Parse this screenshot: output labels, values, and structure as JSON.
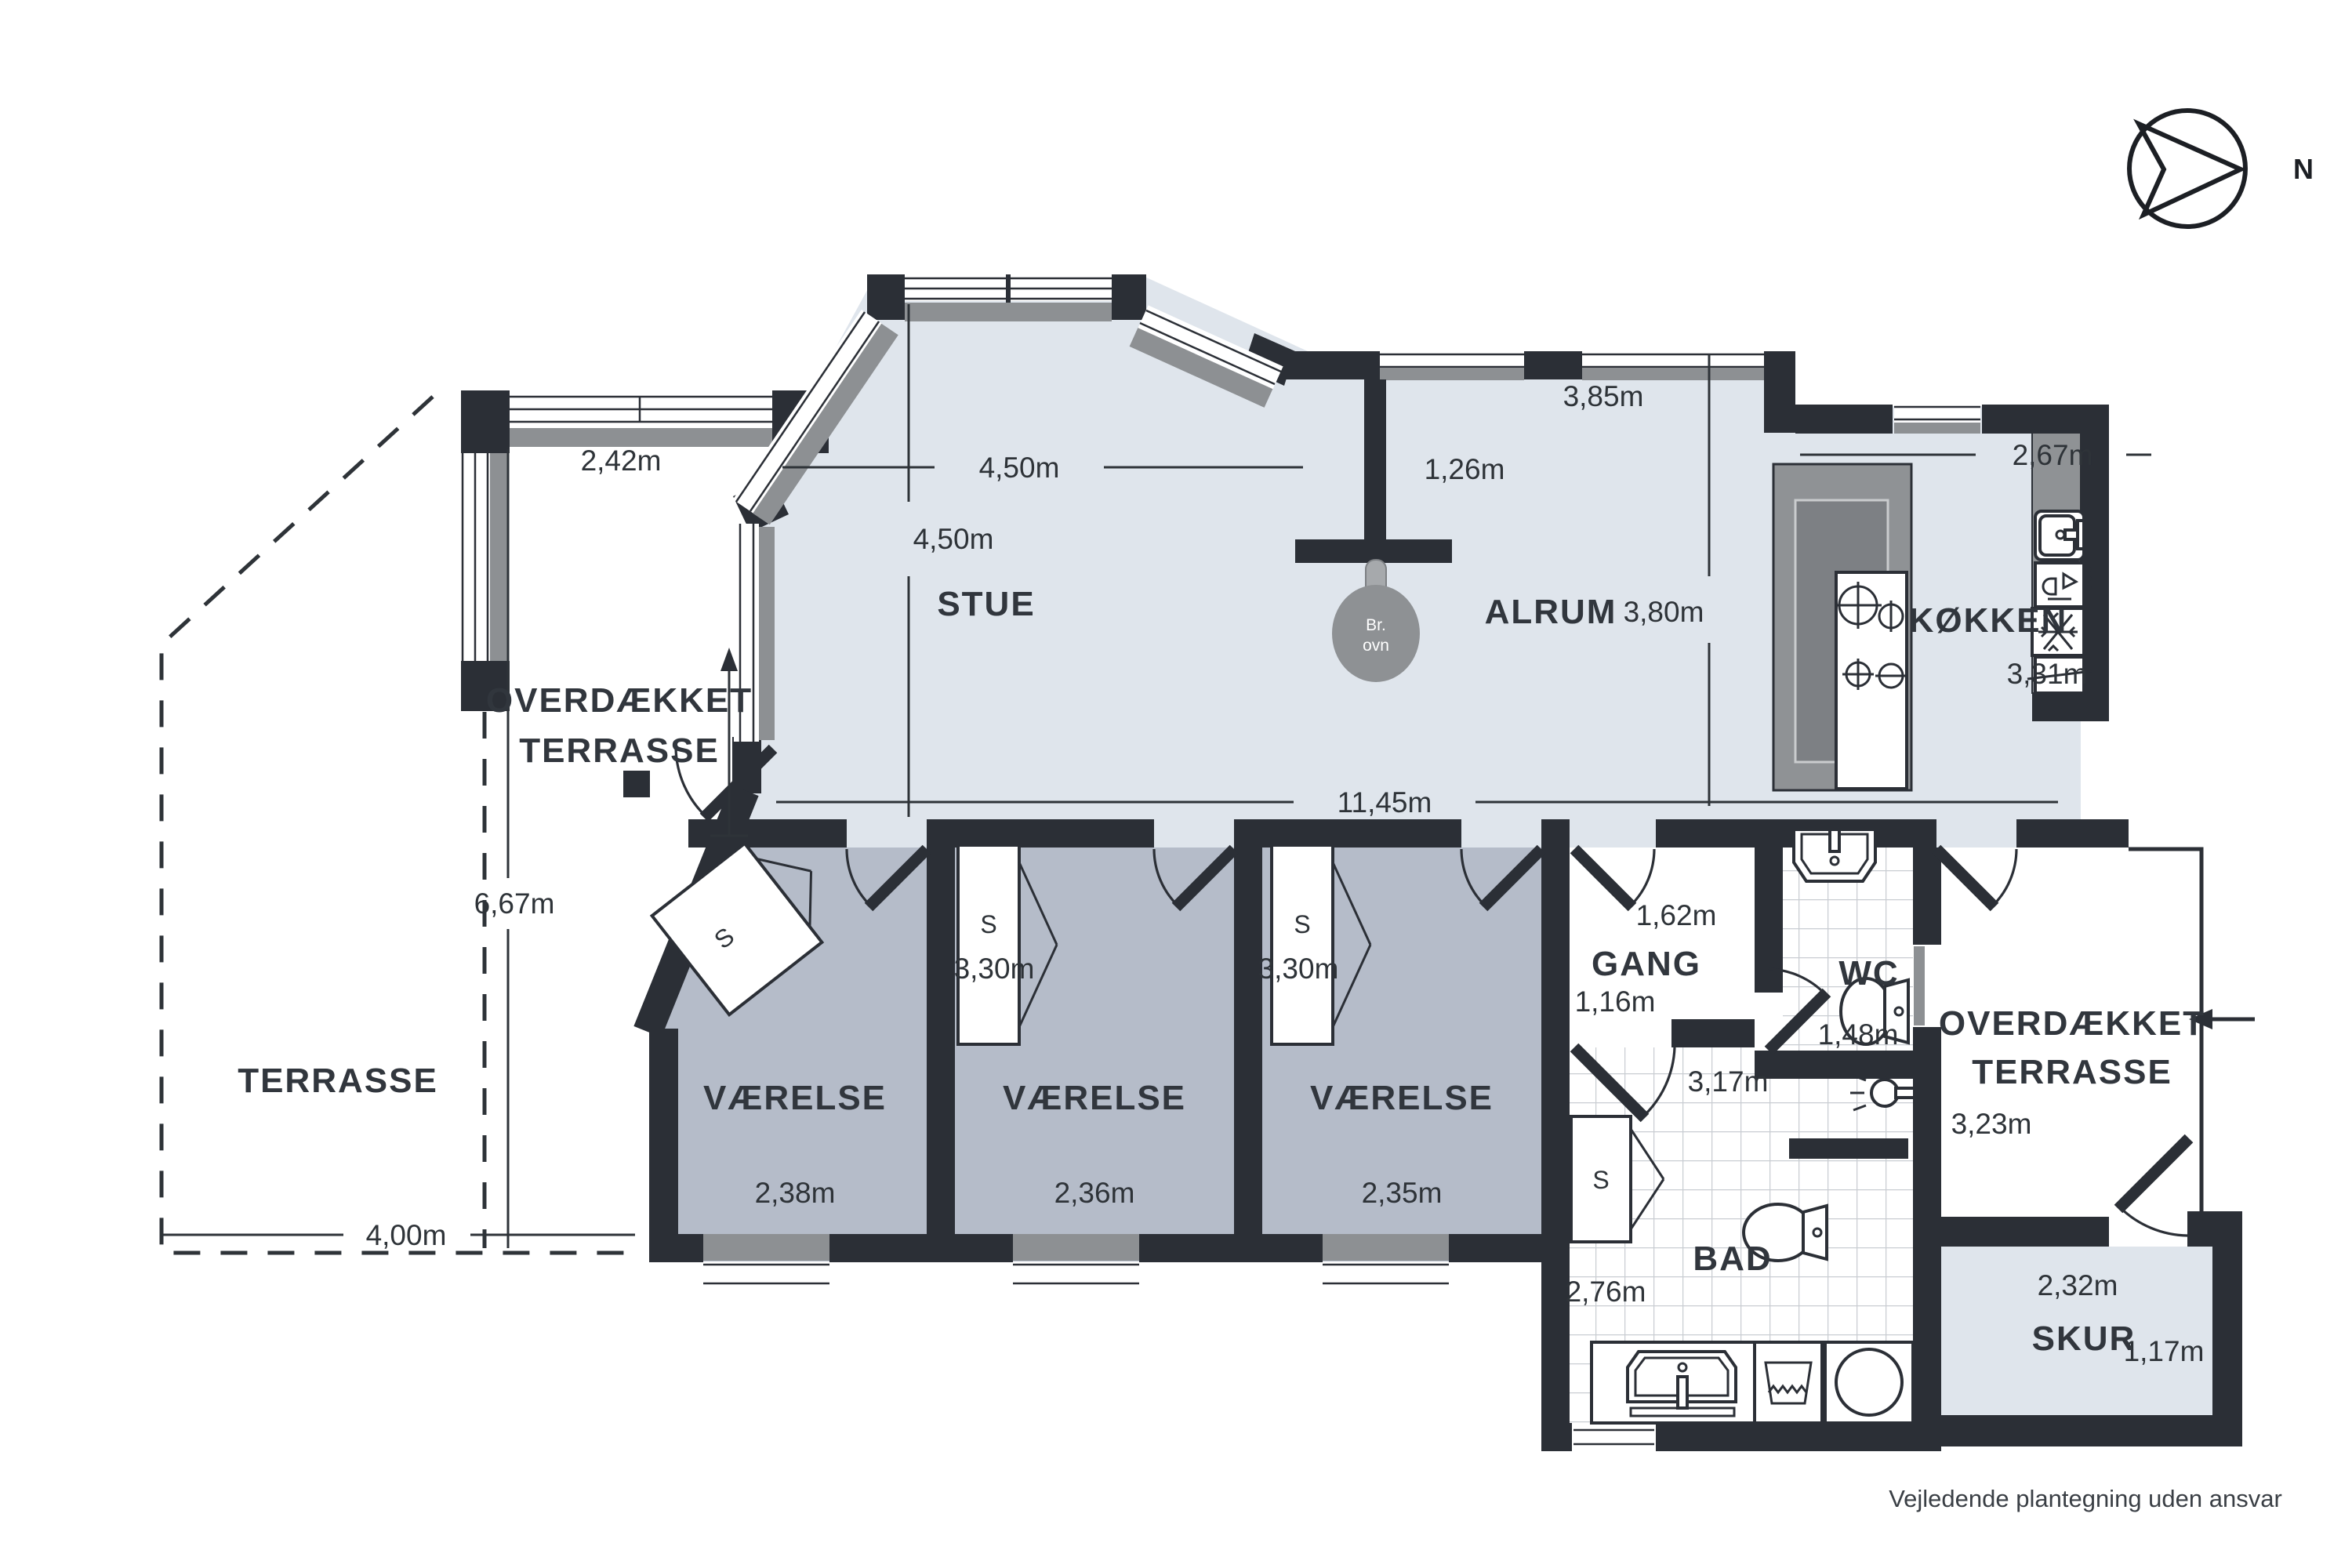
{
  "compass": {
    "north_label": "N"
  },
  "footer": {
    "disclaimer": "Vejledende plantegning uden ansvar"
  },
  "rooms": {
    "stue": "STUE",
    "alrum": "ALRUM",
    "kokken": "KØKKEN",
    "gang": "GANG",
    "wc": "WC",
    "bad": "BAD",
    "skur": "SKUR",
    "vaerelse1": "VÆRELSE",
    "vaerelse2": "VÆRELSE",
    "vaerelse3": "VÆRELSE",
    "terrasse": "TERRASSE",
    "overdaekket_left_line1": "OVERDÆKKET",
    "overdaekket_left_line2": "TERRASSE",
    "overdaekket_right_line1": "OVERDÆKKET",
    "overdaekket_right_line2": "TERRASSE"
  },
  "fixtures": {
    "closet": "S",
    "stove_line1": "Br.",
    "stove_line2": "ovn"
  },
  "dimensions": {
    "terrace_top_width": "2,42m",
    "stue_width": "4,50m",
    "stue_depth": "4,50m",
    "stub_length": "1,26m",
    "alrum_width": "3,85m",
    "alrum_depth": "3,80m",
    "kokken_top_width": "2,67m",
    "kokken_depth": "3,31m",
    "house_width": "11,45m",
    "terrace_left_height": "6,67m",
    "terrasse_width": "4,00m",
    "vaerelse2_depth": "3,30m",
    "vaerelse3_depth": "3,30m",
    "vaerelse1_width": "2,38m",
    "vaerelse2_width": "2,36m",
    "vaerelse3_width": "2,35m",
    "gang_width": "1,62m",
    "gang_opening": "1,16m",
    "wc_width": "1,48m",
    "bad_width": "3,17m",
    "bad_height": "2,76m",
    "terrace_right_height": "3,23m",
    "skur_width": "2,32m",
    "skur_height": "1,17m"
  }
}
